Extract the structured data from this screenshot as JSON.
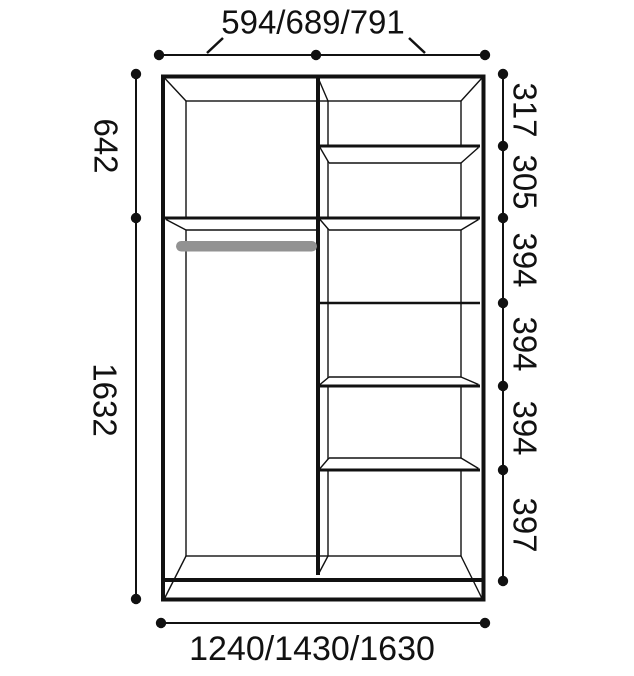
{
  "diagram": {
    "type": "wardrobe-interior-dimension-drawing",
    "units_shown": "millimeters (implied, no unit text shown)"
  },
  "colors": {
    "line": "#111111",
    "rod": "#929292",
    "background": "#ffffff"
  },
  "dimensions": {
    "top_width": "594/689/791",
    "bottom_width": "1240/1430/1630",
    "left_heights": [
      "642",
      "1632"
    ],
    "right_heights": [
      "317",
      "305",
      "394",
      "394",
      "394",
      "397"
    ]
  }
}
